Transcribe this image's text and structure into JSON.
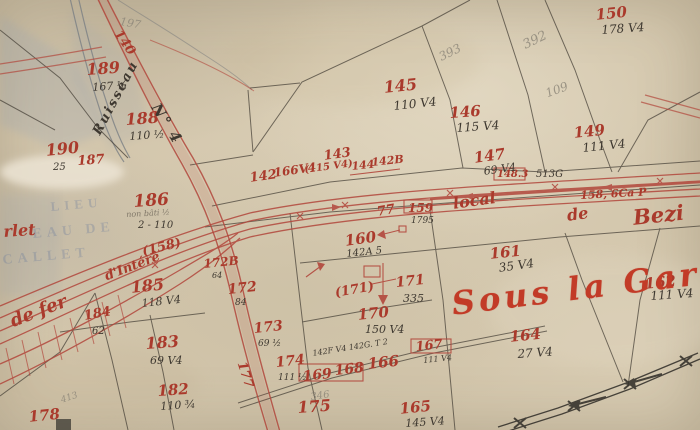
{
  "colors": {
    "paper": "#d3c6ac",
    "ink_red": "#aa3a2c",
    "title_red": "#c23b27",
    "ink_black": "#3e3830",
    "pencil": "#8b8578",
    "ghost_blue": "#66789b"
  },
  "place_name": "Sous la Gare",
  "railway_name_fragments": [
    "de fer",
    "d'Intérê",
    "local",
    "de",
    "Bezi"
  ],
  "stream_name": "Ruisseau",
  "road_name": "N° 4",
  "labels": [
    {
      "t": "189",
      "x": 86,
      "y": 62,
      "s": 16,
      "c": "red",
      "r": -4,
      "n": "parcel-189"
    },
    {
      "t": "167 ½",
      "x": 92,
      "y": 82,
      "s": 11,
      "c": "black",
      "r": -4,
      "n": "parcel-189-area"
    },
    {
      "t": "188",
      "x": 125,
      "y": 112,
      "s": 16,
      "c": "red",
      "r": -4,
      "n": "parcel-188"
    },
    {
      "t": "110 ½",
      "x": 129,
      "y": 131,
      "s": 11,
      "c": "black",
      "r": -4,
      "n": "parcel-188-area"
    },
    {
      "t": "190",
      "x": 45,
      "y": 143,
      "s": 16,
      "c": "red",
      "r": -6,
      "n": "parcel-190"
    },
    {
      "t": "25",
      "x": 53,
      "y": 163,
      "s": 10,
      "c": "black",
      "r": 0,
      "n": "parcel-190-area"
    },
    {
      "t": "187",
      "x": 77,
      "y": 155,
      "s": 13,
      "c": "red",
      "r": -4,
      "n": "parcel-187"
    },
    {
      "t": "186",
      "x": 133,
      "y": 194,
      "s": 17,
      "c": "red",
      "r": -4,
      "n": "parcel-186"
    },
    {
      "t": "non bâti ½",
      "x": 126,
      "y": 211,
      "s": 8,
      "c": "blackfaint",
      "r": -3,
      "n": "parcel-186-note"
    },
    {
      "t": "2 - 110",
      "x": 138,
      "y": 221,
      "s": 10,
      "c": "black",
      "r": 0,
      "n": "parcel-186-area"
    },
    {
      "t": "185",
      "x": 130,
      "y": 280,
      "s": 16,
      "c": "red",
      "r": -6,
      "n": "parcel-185"
    },
    {
      "t": "118 V4",
      "x": 141,
      "y": 298,
      "s": 11,
      "c": "black",
      "r": -6,
      "n": "parcel-185-area"
    },
    {
      "t": "184",
      "x": 83,
      "y": 310,
      "s": 13,
      "c": "red",
      "r": -10,
      "n": "parcel-184"
    },
    {
      "t": "62",
      "x": 92,
      "y": 327,
      "s": 10,
      "c": "black",
      "r": 0,
      "n": "parcel-184-area"
    },
    {
      "t": "183",
      "x": 145,
      "y": 336,
      "s": 16,
      "c": "red",
      "r": -4,
      "n": "parcel-183"
    },
    {
      "t": "69 V4",
      "x": 150,
      "y": 355,
      "s": 11,
      "c": "black",
      "r": 0,
      "n": "parcel-183-area"
    },
    {
      "t": "182",
      "x": 157,
      "y": 384,
      "s": 15,
      "c": "red",
      "r": -4,
      "n": "parcel-182"
    },
    {
      "t": "110 ¾",
      "x": 160,
      "y": 401,
      "s": 11,
      "c": "black",
      "r": -4,
      "n": "parcel-182-area"
    },
    {
      "t": "178",
      "x": 28,
      "y": 410,
      "s": 15,
      "c": "red",
      "r": -6,
      "n": "parcel-178"
    },
    {
      "t": "413",
      "x": 60,
      "y": 397,
      "s": 9,
      "c": "pencil",
      "r": -18,
      "n": "pencil-note"
    },
    {
      "t": "177",
      "x": 247,
      "y": 360,
      "s": 13,
      "c": "red",
      "r": 72,
      "n": "parcel-177"
    },
    {
      "t": "175",
      "x": 297,
      "y": 400,
      "s": 16,
      "c": "red",
      "r": -4,
      "n": "parcel-175"
    },
    {
      "t": "174",
      "x": 275,
      "y": 356,
      "s": 14,
      "c": "red",
      "r": -6,
      "n": "parcel-174"
    },
    {
      "t": "111 ½",
      "x": 278,
      "y": 374,
      "s": 9,
      "c": "black",
      "r": 0,
      "n": "parcel-174-area"
    },
    {
      "t": "173",
      "x": 253,
      "y": 322,
      "s": 14,
      "c": "red",
      "r": -6,
      "n": "parcel-173"
    },
    {
      "t": "69 ½",
      "x": 258,
      "y": 340,
      "s": 9,
      "c": "black",
      "r": 0,
      "n": "parcel-173-area"
    },
    {
      "t": "172",
      "x": 227,
      "y": 283,
      "s": 14,
      "c": "red",
      "r": -6,
      "n": "parcel-172"
    },
    {
      "t": "84",
      "x": 235,
      "y": 299,
      "s": 9,
      "c": "black",
      "r": 0,
      "n": "parcel-172-area"
    },
    {
      "t": "172B",
      "x": 203,
      "y": 258,
      "s": 12,
      "c": "red",
      "r": -6,
      "n": "parcel-172B"
    },
    {
      "t": "64",
      "x": 212,
      "y": 272,
      "s": 8,
      "c": "black",
      "r": 0,
      "n": "parcel-172B-area"
    },
    {
      "t": "171",
      "x": 395,
      "y": 276,
      "s": 14,
      "c": "red",
      "r": -6,
      "n": "parcel-171"
    },
    {
      "t": "335",
      "x": 403,
      "y": 293,
      "s": 11,
      "c": "black",
      "r": 0,
      "n": "parcel-171-area"
    },
    {
      "t": "(171)",
      "x": 334,
      "y": 287,
      "s": 13,
      "c": "red",
      "r": -10,
      "n": "parcel-171-ref"
    },
    {
      "t": "170",
      "x": 357,
      "y": 308,
      "s": 15,
      "c": "red",
      "r": -6,
      "n": "parcel-170"
    },
    {
      "t": "150 V4",
      "x": 365,
      "y": 324,
      "s": 11,
      "c": "black",
      "r": 0,
      "n": "parcel-170-area"
    },
    {
      "t": "169",
      "x": 302,
      "y": 370,
      "s": 14,
      "c": "red",
      "r": -6,
      "n": "parcel-169"
    },
    {
      "t": "168",
      "x": 334,
      "y": 364,
      "s": 14,
      "c": "red",
      "r": -6,
      "n": "parcel-168"
    },
    {
      "t": "166",
      "x": 367,
      "y": 357,
      "s": 15,
      "c": "red",
      "r": -6,
      "n": "parcel-166"
    },
    {
      "t": "167",
      "x": 415,
      "y": 341,
      "s": 13,
      "c": "red",
      "r": -6,
      "n": "parcel-167"
    },
    {
      "t": "111 V4",
      "x": 423,
      "y": 357,
      "s": 8,
      "c": "black",
      "r": -6,
      "n": "parcel-167-area"
    },
    {
      "t": "142F V4 142G. T 2",
      "x": 312,
      "y": 350,
      "s": 8,
      "c": "black",
      "r": -9,
      "n": "annotation-row"
    },
    {
      "t": "346",
      "x": 310,
      "y": 393,
      "s": 10,
      "c": "pencil",
      "r": -8,
      "n": "pencil-note"
    },
    {
      "t": "165",
      "x": 399,
      "y": 402,
      "s": 15,
      "c": "red",
      "r": -6,
      "n": "parcel-165"
    },
    {
      "t": "145 V4",
      "x": 405,
      "y": 418,
      "s": 11,
      "c": "black",
      "r": -4,
      "n": "parcel-165-area"
    },
    {
      "t": "164",
      "x": 509,
      "y": 330,
      "s": 15,
      "c": "red",
      "r": -6,
      "n": "parcel-164"
    },
    {
      "t": "27 V4",
      "x": 517,
      "y": 348,
      "s": 12,
      "c": "black",
      "r": -4,
      "n": "parcel-164-area"
    },
    {
      "t": "162",
      "x": 644,
      "y": 277,
      "s": 15,
      "c": "red",
      "r": -6,
      "n": "parcel-162"
    },
    {
      "t": "111 V4",
      "x": 650,
      "y": 290,
      "s": 12,
      "c": "black",
      "r": -4,
      "n": "parcel-162-area"
    },
    {
      "t": "161",
      "x": 489,
      "y": 247,
      "s": 15,
      "c": "red",
      "r": -6,
      "n": "parcel-161"
    },
    {
      "t": "35 V4",
      "x": 498,
      "y": 262,
      "s": 12,
      "c": "black",
      "r": -8,
      "n": "parcel-161-area"
    },
    {
      "t": "160",
      "x": 344,
      "y": 234,
      "s": 15,
      "c": "red",
      "r": -8,
      "n": "parcel-160"
    },
    {
      "t": "142A 5",
      "x": 346,
      "y": 250,
      "s": 10,
      "c": "black",
      "r": -6,
      "n": "parcel-160-area"
    },
    {
      "t": "159",
      "x": 408,
      "y": 202,
      "s": 12,
      "c": "red",
      "r": 0,
      "n": "parcel-159"
    },
    {
      "t": "1795",
      "x": 411,
      "y": 217,
      "s": 9,
      "c": "black",
      "r": 0,
      "n": "parcel-159-area"
    },
    {
      "t": "77",
      "x": 376,
      "y": 206,
      "s": 13,
      "c": "red",
      "r": -10,
      "n": "mark-77"
    },
    {
      "t": "148.3",
      "x": 497,
      "y": 170,
      "s": 10,
      "c": "red",
      "r": 0,
      "n": "parcel-148"
    },
    {
      "t": "513G",
      "x": 536,
      "y": 170,
      "s": 10,
      "c": "black",
      "r": 0,
      "n": "mark-513G"
    },
    {
      "t": "158, 6Ca P",
      "x": 580,
      "y": 190,
      "s": 11,
      "c": "red",
      "r": -3,
      "n": "railway-mark-158"
    },
    {
      "t": "147",
      "x": 473,
      "y": 151,
      "s": 15,
      "c": "red",
      "r": -8,
      "n": "parcel-147"
    },
    {
      "t": "69 V4",
      "x": 483,
      "y": 166,
      "s": 11,
      "c": "black",
      "r": -8,
      "n": "parcel-147-area"
    },
    {
      "t": "146",
      "x": 449,
      "y": 106,
      "s": 15,
      "c": "red",
      "r": -4,
      "n": "parcel-146"
    },
    {
      "t": "115 V4",
      "x": 456,
      "y": 122,
      "s": 12,
      "c": "black",
      "r": -4,
      "n": "parcel-146-area"
    },
    {
      "t": "145",
      "x": 383,
      "y": 80,
      "s": 16,
      "c": "red",
      "r": -6,
      "n": "parcel-145"
    },
    {
      "t": "110 V4",
      "x": 393,
      "y": 100,
      "s": 12,
      "c": "black",
      "r": -6,
      "n": "parcel-145-area"
    },
    {
      "t": "149",
      "x": 573,
      "y": 126,
      "s": 15,
      "c": "red",
      "r": -6,
      "n": "parcel-149"
    },
    {
      "t": "111 V4",
      "x": 582,
      "y": 142,
      "s": 12,
      "c": "black",
      "r": -6,
      "n": "parcel-149-area"
    },
    {
      "t": "150",
      "x": 595,
      "y": 8,
      "s": 15,
      "c": "red",
      "r": -6,
      "n": "parcel-150"
    },
    {
      "t": "178 V4",
      "x": 601,
      "y": 24,
      "s": 12,
      "c": "black",
      "r": -4,
      "n": "parcel-150-area"
    },
    {
      "t": "143",
      "x": 323,
      "y": 150,
      "s": 13,
      "c": "red",
      "r": -8,
      "n": "parcel-143"
    },
    {
      "t": "(115 V4)",
      "x": 304,
      "y": 166,
      "s": 10,
      "c": "red",
      "r": -8,
      "n": "parcel-143-area"
    },
    {
      "t": "144",
      "x": 351,
      "y": 161,
      "s": 11,
      "c": "red",
      "r": -6,
      "n": "parcel-144"
    },
    {
      "t": "142B",
      "x": 371,
      "y": 157,
      "s": 11,
      "c": "red",
      "r": -6,
      "n": "parcel-142B"
    },
    {
      "t": "142",
      "x": 249,
      "y": 172,
      "s": 13,
      "c": "red",
      "r": -8,
      "n": "parcel-142"
    },
    {
      "t": "166V4",
      "x": 273,
      "y": 167,
      "s": 12,
      "c": "red",
      "r": -8,
      "n": "parcel-142-area"
    },
    {
      "t": "392",
      "x": 521,
      "y": 40,
      "s": 13,
      "c": "pencil",
      "r": -26,
      "n": "pencil-392"
    },
    {
      "t": "393",
      "x": 437,
      "y": 52,
      "s": 12,
      "c": "pencil",
      "r": -26,
      "n": "pencil-393"
    },
    {
      "t": "109",
      "x": 544,
      "y": 88,
      "s": 12,
      "c": "pencil",
      "r": -20,
      "n": "pencil-109"
    },
    {
      "t": "197",
      "x": 121,
      "y": 16,
      "s": 11,
      "c": "pencil",
      "r": 10,
      "n": "pencil-197"
    },
    {
      "t": "140",
      "x": 122,
      "y": 28,
      "s": 13,
      "c": "red",
      "r": 55,
      "n": "road-number-140"
    },
    {
      "t": "N° 4",
      "x": 161,
      "y": 101,
      "s": 15,
      "c": "script",
      "r": 58,
      "n": "road-no4-label"
    },
    {
      "t": "Ruisseau",
      "x": 91,
      "y": 131,
      "s": 13,
      "c": "script",
      "r": -62,
      "n": "ruisseau-label"
    },
    {
      "t": "de fer",
      "x": 8,
      "y": 314,
      "s": 18,
      "c": "red",
      "r": -21,
      "n": "railway-name-de-fer"
    },
    {
      "t": "rlet",
      "x": 3,
      "y": 224,
      "s": 16,
      "c": "red",
      "r": -4,
      "n": "place-name-fragment"
    },
    {
      "t": "(158)",
      "x": 141,
      "y": 246,
      "s": 13,
      "c": "red",
      "r": -14,
      "n": "parcel-158-ref"
    },
    {
      "t": "d'Intérê",
      "x": 103,
      "y": 271,
      "s": 13,
      "c": "red",
      "r": -21,
      "n": "railway-name-interet"
    },
    {
      "t": "local",
      "x": 452,
      "y": 196,
      "s": 16,
      "c": "red",
      "r": -8,
      "n": "railway-name-local"
    },
    {
      "t": "de",
      "x": 566,
      "y": 208,
      "s": 16,
      "c": "red",
      "r": -8,
      "n": "railway-name-de"
    },
    {
      "t": "Bezi",
      "x": 632,
      "y": 207,
      "s": 21,
      "c": "red",
      "r": -6,
      "n": "railway-name-beziers"
    },
    {
      "t": "Sous la Gare",
      "x": 450,
      "y": 288,
      "s": 32,
      "c": "sous",
      "r": -7,
      "n": "place-name-sous-la-gare"
    },
    {
      "t": "LIEU",
      "x": 50,
      "y": 200,
      "s": 13,
      "c": "ghost",
      "r": -5,
      "n": "ghost-stamp-line1"
    },
    {
      "t": "EAU DE",
      "x": 32,
      "y": 228,
      "s": 14,
      "c": "ghost",
      "r": -5,
      "n": "ghost-stamp-line2"
    },
    {
      "t": "CALLET",
      "x": 2,
      "y": 254,
      "s": 14,
      "c": "ghost",
      "r": -5,
      "n": "ghost-stamp-line3"
    }
  ]
}
